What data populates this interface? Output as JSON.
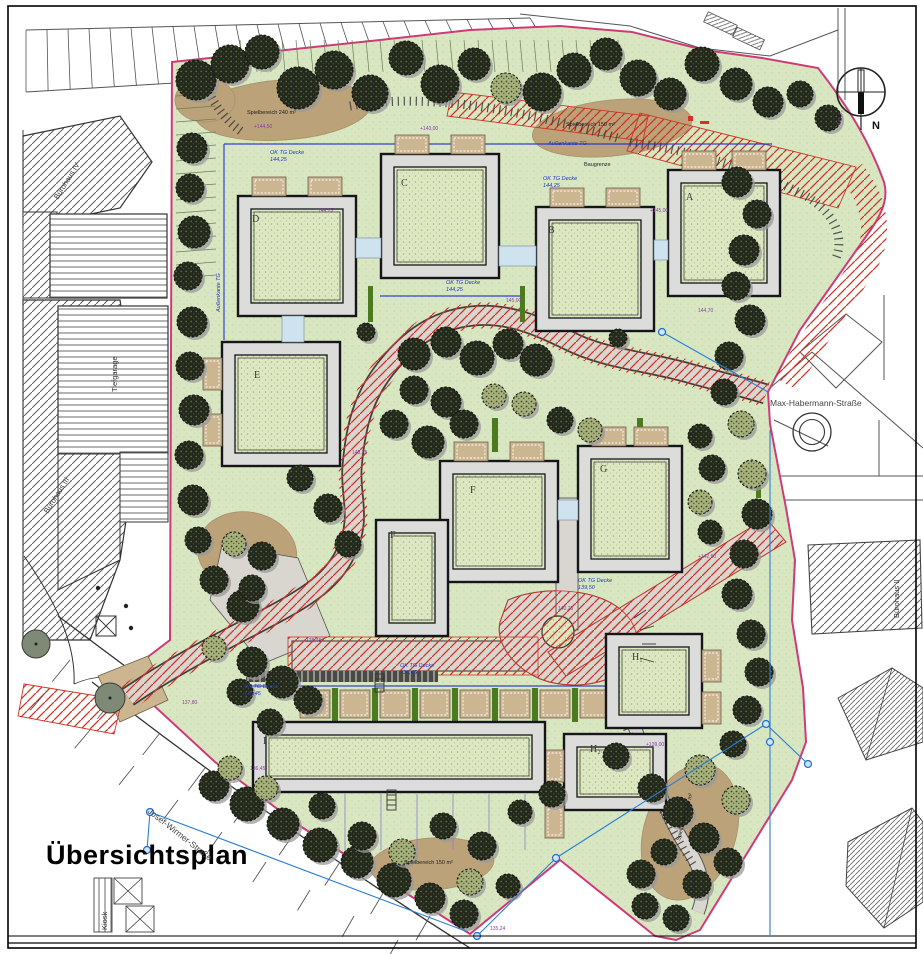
{
  "meta": {
    "title": "Übersichtsplan",
    "compass": "N"
  },
  "colors": {
    "lawn": "#d8e6c2",
    "roof_green": "#dde7c2",
    "building_gray": "#dcdcda",
    "sand": "#bba278",
    "pavement": "#d8d6cf",
    "fire_red": "#cf3526",
    "boundary_pink": "#cf3a78",
    "tg_blue": "#2233cc",
    "survey_blue": "#2a7fd4",
    "terrace_tan": "#ccb591",
    "hedge_green": "#4c7a1e",
    "note_purple": "#8a3fa8"
  },
  "streets": [
    {
      "name": "Max-Habermann-Straße",
      "x": 770,
      "y": 398,
      "rot": 0
    },
    {
      "name": "Josef-Wirmer-Straße",
      "x": 152,
      "y": 806,
      "rot": 38
    }
  ],
  "context_labels": [
    {
      "name": "Bürohaus IV",
      "x": 52,
      "y": 196,
      "rot": -58
    },
    {
      "name": "Bürohaus III",
      "x": 42,
      "y": 510,
      "rot": -58
    },
    {
      "name": "Tiefgarage",
      "x": 110,
      "y": 392,
      "rot": -90
    },
    {
      "name": "Bürohaus II",
      "x": 892,
      "y": 618,
      "rot": -90
    },
    {
      "name": "Kiosk",
      "x": 100,
      "y": 930,
      "rot": -90
    }
  ],
  "buildings": [
    {
      "label": "A",
      "x": 668,
      "y": 170,
      "w": 112,
      "h": 126,
      "lx": 18,
      "ly": 22,
      "terrace": "top"
    },
    {
      "label": "B",
      "x": 536,
      "y": 207,
      "w": 118,
      "h": 124,
      "lx": 12,
      "ly": 18,
      "terrace": "top"
    },
    {
      "label": "C",
      "x": 381,
      "y": 154,
      "w": 118,
      "h": 124,
      "lx": 20,
      "ly": 24,
      "terrace": "top"
    },
    {
      "label": "D",
      "x": 238,
      "y": 196,
      "w": 118,
      "h": 120,
      "lx": 14,
      "ly": 18,
      "terrace": "top"
    },
    {
      "label": "E",
      "x": 222,
      "y": 342,
      "w": 118,
      "h": 124,
      "lx": 32,
      "ly": 28,
      "terrace": "left"
    },
    {
      "label": "F",
      "x": 440,
      "y": 461,
      "w": 118,
      "h": 121,
      "lx": 30,
      "ly": 24,
      "terrace": "top"
    },
    {
      "label": "F",
      "x": 376,
      "y": 520,
      "w": 72,
      "h": 116,
      "lx": 14,
      "ly": 10,
      "terrace": "none"
    },
    {
      "label": "G",
      "x": 578,
      "y": 446,
      "w": 104,
      "h": 126,
      "lx": 22,
      "ly": 18,
      "terrace": "top"
    },
    {
      "label": "H₁",
      "x": 606,
      "y": 634,
      "w": 96,
      "h": 94,
      "lx": 26,
      "ly": 18,
      "terrace": "right"
    },
    {
      "label": "H₂",
      "x": 564,
      "y": 734,
      "w": 102,
      "h": 76,
      "lx": 26,
      "ly": 10,
      "terrace": "left"
    },
    {
      "label": "I",
      "x": 253,
      "y": 722,
      "w": 292,
      "h": 70,
      "lx": 10,
      "ly": 14,
      "terrace": "none"
    }
  ],
  "garden_row": {
    "cells": 9,
    "x": 300,
    "y": 690,
    "cell_w": 30,
    "cell_h": 28,
    "gap": 10
  },
  "annotations": {
    "blue": [
      {
        "text": "OK TG Decke 144,25",
        "x": 270,
        "y": 150,
        "w": 44
      },
      {
        "text": "OK TG Decke 144,25",
        "x": 543,
        "y": 176,
        "w": 44
      },
      {
        "text": "Außenkante TG",
        "x": 548,
        "y": 141,
        "w": 72
      },
      {
        "text": "Außenkante TG",
        "x": 216,
        "y": 312,
        "w": 72,
        "rot": -90
      },
      {
        "text": "OK TG Decke 144,25",
        "x": 446,
        "y": 280,
        "w": 46
      },
      {
        "text": "OK TG Decke 139,50",
        "x": 578,
        "y": 578,
        "w": 46
      },
      {
        "text": "OK TG Decke 136,45",
        "x": 244,
        "y": 684,
        "w": 46
      },
      {
        "text": "OK TG Decke 136,45",
        "x": 400,
        "y": 663,
        "w": 46
      }
    ],
    "black": [
      {
        "text": "Spielbereich 240 m²",
        "x": 247,
        "y": 110
      },
      {
        "text": "Spielbereich 150 m²",
        "x": 566,
        "y": 122
      },
      {
        "text": "Baugrenze",
        "x": 584,
        "y": 162
      },
      {
        "text": "Spielbereich 150 m²",
        "x": 404,
        "y": 860
      },
      {
        "text": "Spielbereich 150 m²",
        "x": 676,
        "y": 840,
        "rot": -75
      }
    ],
    "purple": [
      {
        "text": "+144,50",
        "x": 254,
        "y": 124
      },
      {
        "text": "+143,00",
        "x": 420,
        "y": 126
      },
      {
        "text": "144,25",
        "x": 318,
        "y": 208
      },
      {
        "text": "145,00",
        "x": 506,
        "y": 298
      },
      {
        "text": "+145,00",
        "x": 650,
        "y": 208
      },
      {
        "text": "144,70",
        "x": 698,
        "y": 308
      },
      {
        "text": "143,25",
        "x": 352,
        "y": 450
      },
      {
        "text": "+142,50",
        "x": 698,
        "y": 554
      },
      {
        "text": "140,25",
        "x": 558,
        "y": 606
      },
      {
        "text": "138,45",
        "x": 306,
        "y": 638
      },
      {
        "text": "137,80",
        "x": 182,
        "y": 700
      },
      {
        "text": "136,45",
        "x": 250,
        "y": 766
      },
      {
        "text": "+139,00",
        "x": 646,
        "y": 742
      },
      {
        "text": "135,24",
        "x": 490,
        "y": 926
      },
      {
        "text": "141,77",
        "x": 836,
        "y": 124,
        "rot": -70
      }
    ]
  },
  "trees": [
    [
      196,
      80,
      20,
      "d"
    ],
    [
      230,
      64,
      19,
      "d"
    ],
    [
      262,
      52,
      17,
      "d"
    ],
    [
      298,
      88,
      21,
      "d"
    ],
    [
      334,
      70,
      19,
      "d"
    ],
    [
      370,
      93,
      18,
      "d"
    ],
    [
      406,
      58,
      17,
      "d"
    ],
    [
      440,
      84,
      19,
      "d"
    ],
    [
      474,
      64,
      16,
      "d"
    ],
    [
      506,
      88,
      15,
      "l"
    ],
    [
      542,
      92,
      19,
      "d"
    ],
    [
      574,
      70,
      17,
      "d"
    ],
    [
      606,
      54,
      16,
      "d"
    ],
    [
      638,
      78,
      18,
      "d"
    ],
    [
      670,
      94,
      16,
      "d"
    ],
    [
      702,
      64,
      17,
      "d"
    ],
    [
      736,
      84,
      16,
      "d"
    ],
    [
      768,
      102,
      15,
      "d"
    ],
    [
      800,
      94,
      13,
      "d"
    ],
    [
      828,
      118,
      13,
      "d"
    ],
    [
      192,
      148,
      15,
      "d"
    ],
    [
      190,
      188,
      14,
      "d"
    ],
    [
      194,
      232,
      16,
      "d"
    ],
    [
      188,
      276,
      14,
      "d"
    ],
    [
      192,
      322,
      15,
      "d"
    ],
    [
      190,
      366,
      14,
      "d"
    ],
    [
      194,
      410,
      15,
      "d"
    ],
    [
      189,
      455,
      14,
      "d"
    ],
    [
      193,
      500,
      15,
      "d"
    ],
    [
      198,
      540,
      13,
      "d"
    ],
    [
      214,
      580,
      14,
      "d"
    ],
    [
      243,
      606,
      16,
      "d"
    ],
    [
      214,
      648,
      12,
      "l"
    ],
    [
      252,
      662,
      15,
      "d"
    ],
    [
      282,
      682,
      16,
      "d"
    ],
    [
      240,
      692,
      13,
      "d"
    ],
    [
      308,
      700,
      14,
      "d"
    ],
    [
      270,
      722,
      13,
      "d"
    ],
    [
      214,
      786,
      15,
      "d"
    ],
    [
      247,
      804,
      17,
      "d"
    ],
    [
      283,
      824,
      16,
      "d"
    ],
    [
      320,
      845,
      17,
      "d"
    ],
    [
      357,
      862,
      16,
      "d"
    ],
    [
      394,
      880,
      17,
      "d"
    ],
    [
      430,
      898,
      15,
      "d"
    ],
    [
      464,
      914,
      14,
      "d"
    ],
    [
      230,
      768,
      12,
      "l"
    ],
    [
      266,
      788,
      12,
      "l"
    ],
    [
      322,
      806,
      13,
      "d"
    ],
    [
      362,
      836,
      14,
      "d"
    ],
    [
      402,
      852,
      13,
      "l"
    ],
    [
      443,
      826,
      13,
      "d"
    ],
    [
      482,
      846,
      14,
      "d"
    ],
    [
      520,
      812,
      12,
      "d"
    ],
    [
      552,
      794,
      13,
      "d"
    ],
    [
      470,
      882,
      13,
      "l"
    ],
    [
      508,
      886,
      12,
      "d"
    ],
    [
      616,
      756,
      13,
      "d"
    ],
    [
      652,
      788,
      14,
      "d"
    ],
    [
      678,
      812,
      15,
      "d"
    ],
    [
      704,
      838,
      15,
      "d"
    ],
    [
      728,
      862,
      14,
      "d"
    ],
    [
      664,
      852,
      13,
      "d"
    ],
    [
      641,
      874,
      14,
      "d"
    ],
    [
      697,
      884,
      14,
      "d"
    ],
    [
      645,
      906,
      13,
      "d"
    ],
    [
      676,
      918,
      13,
      "d"
    ],
    [
      700,
      770,
      15,
      "l"
    ],
    [
      736,
      800,
      14,
      "l"
    ],
    [
      737,
      182,
      15,
      "d"
    ],
    [
      757,
      214,
      14,
      "d"
    ],
    [
      744,
      250,
      15,
      "d"
    ],
    [
      736,
      286,
      14,
      "d"
    ],
    [
      750,
      320,
      15,
      "d"
    ],
    [
      729,
      356,
      14,
      "d"
    ],
    [
      724,
      392,
      13,
      "d"
    ],
    [
      741,
      424,
      13,
      "l"
    ],
    [
      752,
      474,
      14,
      "l"
    ],
    [
      757,
      514,
      15,
      "d"
    ],
    [
      744,
      554,
      14,
      "d"
    ],
    [
      737,
      594,
      15,
      "d"
    ],
    [
      751,
      634,
      14,
      "d"
    ],
    [
      759,
      672,
      14,
      "d"
    ],
    [
      747,
      710,
      14,
      "d"
    ],
    [
      733,
      744,
      13,
      "d"
    ],
    [
      414,
      354,
      16,
      "d"
    ],
    [
      446,
      342,
      15,
      "d"
    ],
    [
      477,
      358,
      17,
      "d"
    ],
    [
      508,
      344,
      15,
      "d"
    ],
    [
      536,
      360,
      16,
      "d"
    ],
    [
      414,
      390,
      14,
      "d"
    ],
    [
      446,
      402,
      15,
      "d"
    ],
    [
      394,
      424,
      14,
      "d"
    ],
    [
      428,
      442,
      16,
      "d"
    ],
    [
      464,
      424,
      14,
      "d"
    ],
    [
      494,
      396,
      12,
      "l"
    ],
    [
      524,
      404,
      12,
      "l"
    ],
    [
      560,
      420,
      13,
      "d"
    ],
    [
      590,
      430,
      12,
      "l"
    ],
    [
      300,
      478,
      13,
      "d"
    ],
    [
      328,
      508,
      14,
      "d"
    ],
    [
      348,
      544,
      13,
      "d"
    ],
    [
      262,
      556,
      14,
      "d"
    ],
    [
      234,
      544,
      12,
      "l"
    ],
    [
      252,
      588,
      13,
      "d"
    ],
    [
      700,
      436,
      12,
      "d"
    ],
    [
      712,
      468,
      13,
      "d"
    ],
    [
      700,
      502,
      12,
      "l"
    ],
    [
      710,
      532,
      12,
      "d"
    ],
    [
      366,
      332,
      9,
      "d"
    ],
    [
      618,
      338,
      9,
      "d"
    ],
    [
      36,
      644,
      14,
      "o"
    ],
    [
      110,
      698,
      15,
      "o"
    ]
  ],
  "survey": {
    "lines": [
      [
        150,
        812,
        468,
        932
      ],
      [
        150,
        812,
        147,
        850
      ],
      [
        556,
        858,
        766,
        724
      ],
      [
        556,
        858,
        477,
        936
      ],
      [
        766,
        724,
        808,
        764
      ],
      [
        770,
        430,
        770,
        935
      ],
      [
        662,
        332,
        768,
        392
      ]
    ],
    "nodes": [
      [
        150,
        812
      ],
      [
        147,
        850
      ],
      [
        556,
        858
      ],
      [
        766,
        724
      ],
      [
        808,
        764
      ],
      [
        477,
        936
      ],
      [
        770,
        742
      ],
      [
        662,
        332
      ]
    ]
  }
}
